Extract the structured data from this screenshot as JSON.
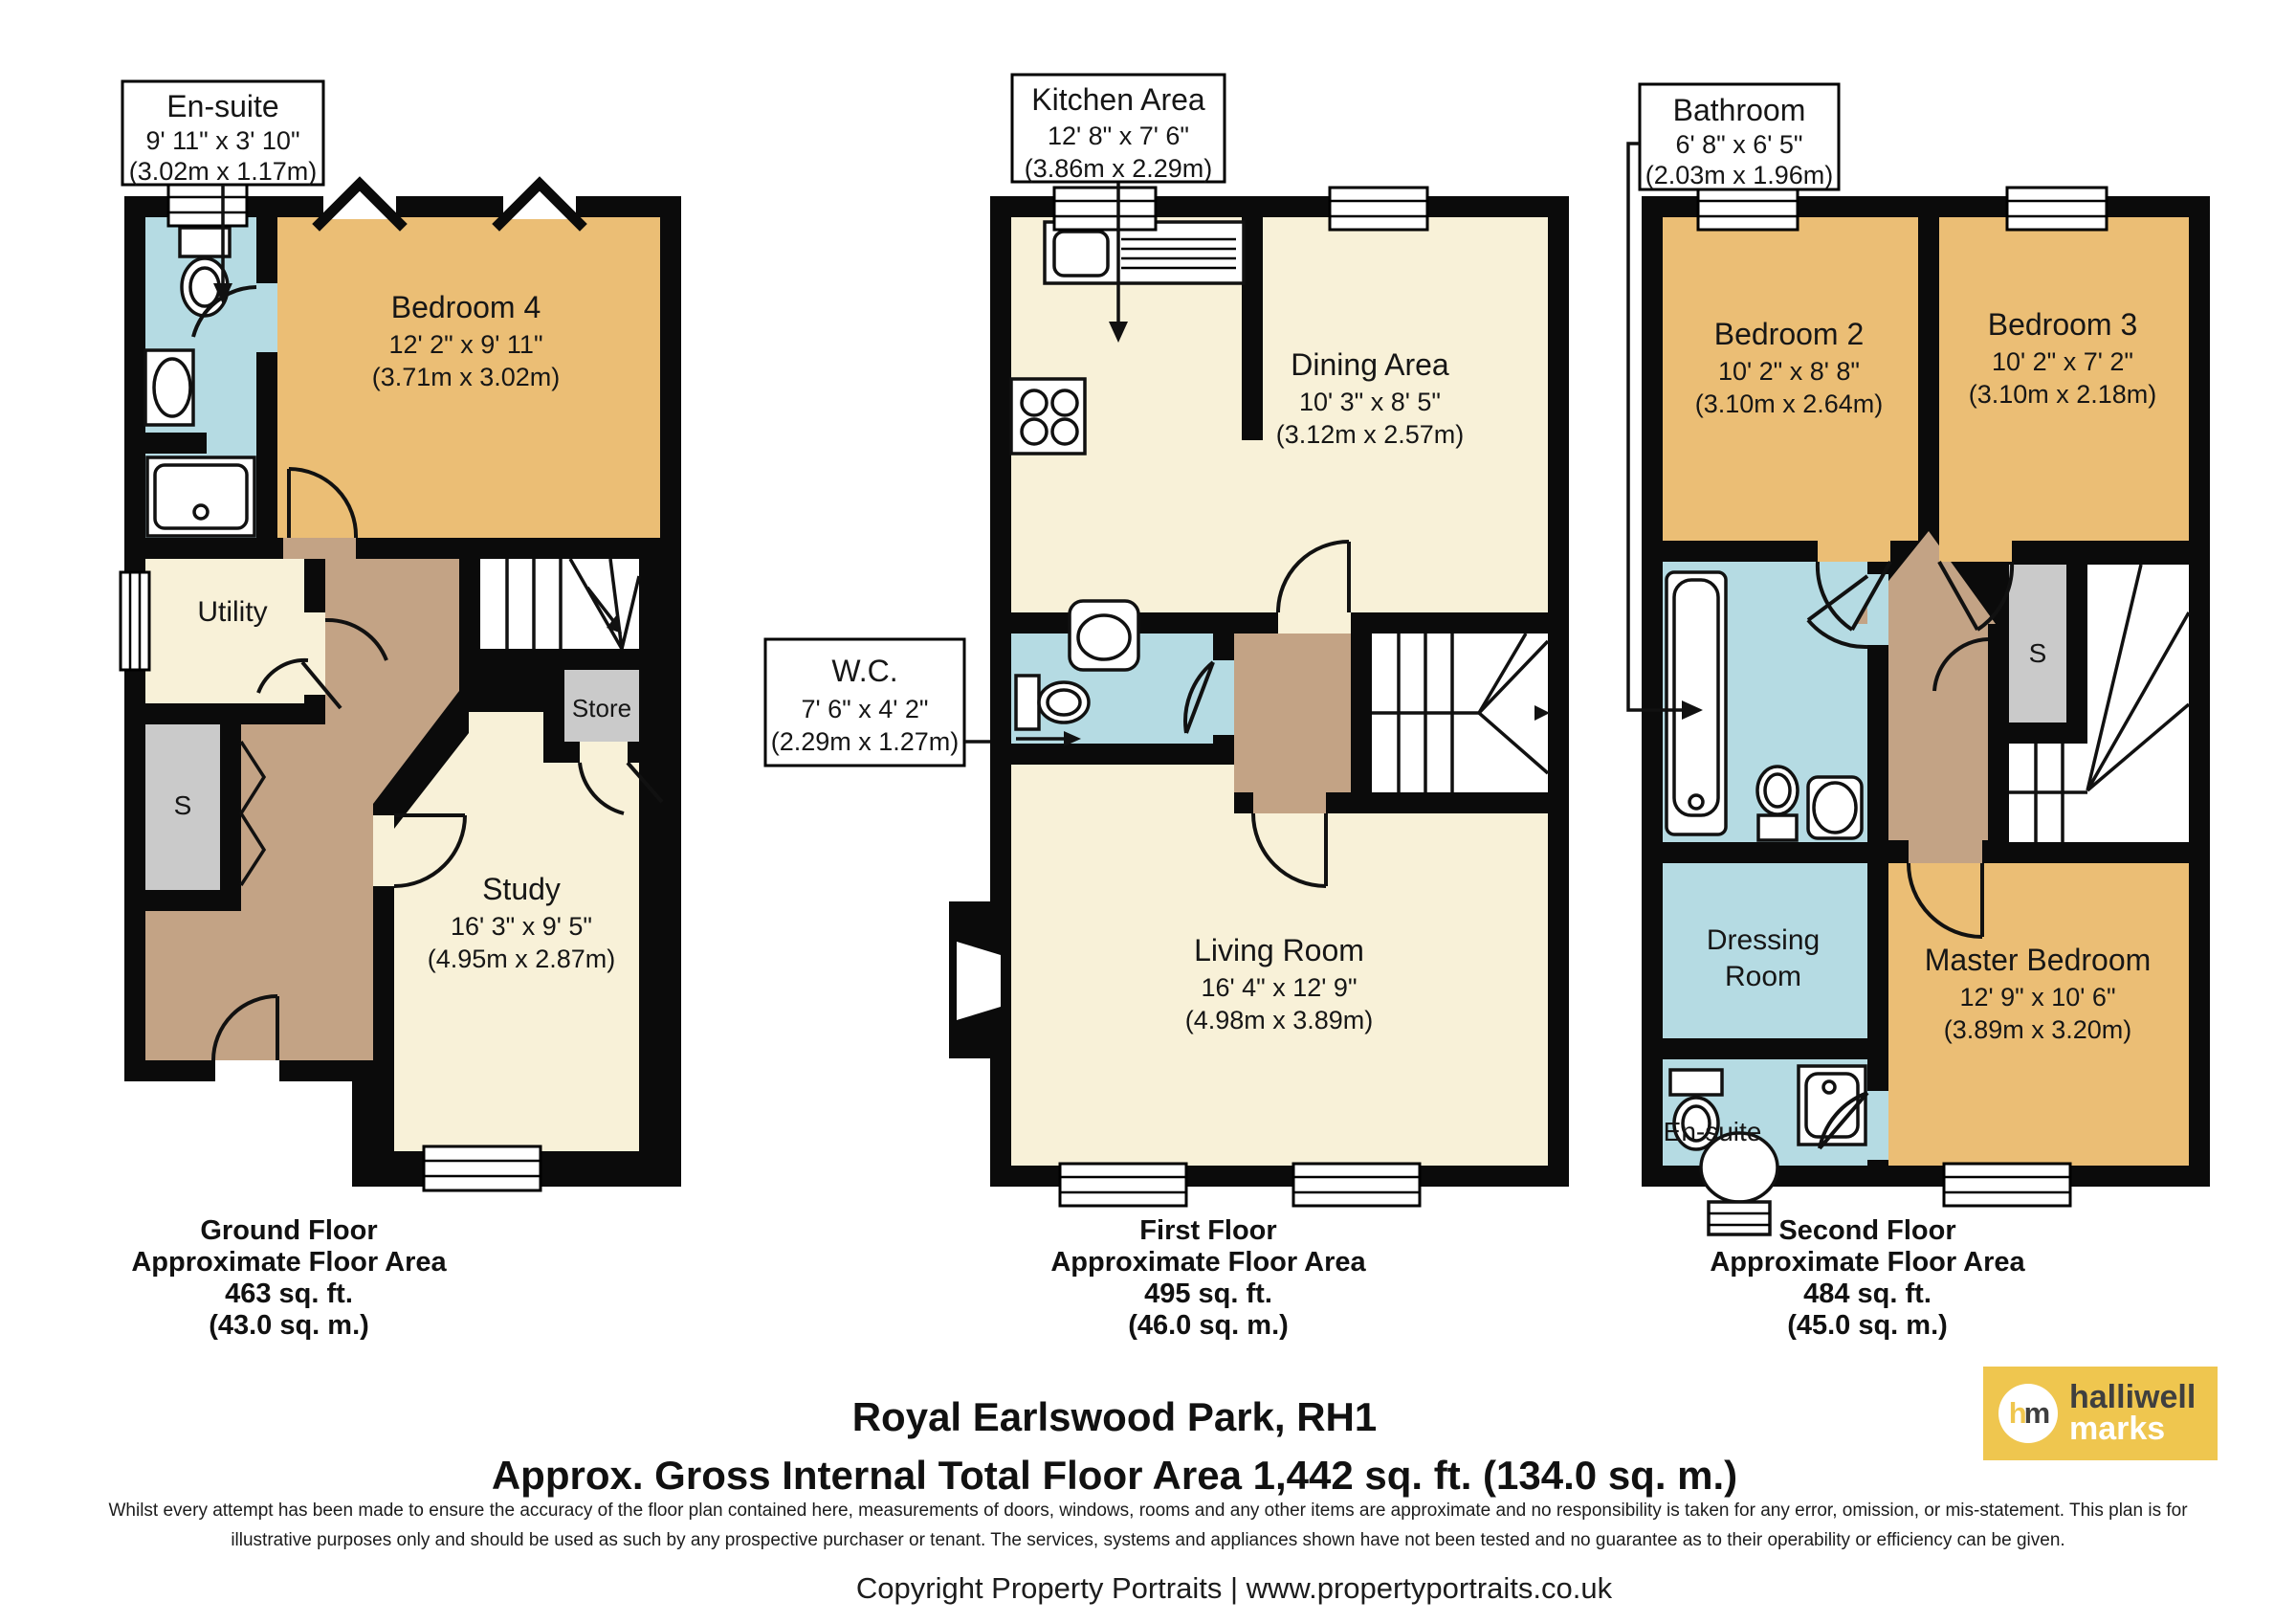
{
  "title": {
    "line1": "Royal Earlswood Park, RH1",
    "line2": "Approx. Gross Internal Total Floor Area 1,442 sq. ft. (134.0 sq. m.)"
  },
  "disclaimer": {
    "line1": "Whilst every attempt has been made to ensure the accuracy of the floor plan contained here, measurements of doors, windows, rooms and any other items are approximate and no responsibility is taken for any error, omission, or mis-statement. This plan is for",
    "line2": "illustrative purposes only and should be used as such by any prospective purchaser or tenant. The services, systems and appliances shown have not been tested and no guarantee as to their operability or efficiency can be given."
  },
  "copyright": "Copyright Property Portraits | www.propertyportraits.co.uk",
  "logo": {
    "letter_h": "h",
    "letter_m": "m",
    "word1": "halliwell",
    "word2": "marks"
  },
  "colors": {
    "room_tan": "#EBBE75",
    "room_cream": "#F8F1D8",
    "room_blue": "#B5DBE3",
    "hall_brown": "#C3A385",
    "cupboard_gray": "#CACACA",
    "wall": "#0B0B0B",
    "logo_yellow": "#EFC64F"
  },
  "floors": [
    {
      "caption": {
        "title": "Ground Floor",
        "subtitle": "Approximate Floor Area",
        "area_ft": "463 sq. ft.",
        "area_m": "(43.0 sq. m.)"
      },
      "boxes": {
        "ensuite": {
          "title": "En-suite",
          "imperial": "9' 11\" x 3' 10\"",
          "metric": "(3.02m x 1.17m)"
        }
      },
      "rooms": {
        "bedroom4": {
          "name": "Bedroom 4",
          "imperial": "12' 2\" x 9' 11\"",
          "metric": "(3.71m x 3.02m)"
        },
        "utility": {
          "name": "Utility"
        },
        "study": {
          "name": "Study",
          "imperial": "16' 3\" x 9' 5\"",
          "metric": "(4.95m x 2.87m)"
        },
        "store": {
          "name": "Store"
        },
        "cupboard": {
          "name": "S"
        }
      }
    },
    {
      "caption": {
        "title": "First Floor",
        "subtitle": "Approximate Floor Area",
        "area_ft": "495 sq. ft.",
        "area_m": "(46.0 sq. m.)"
      },
      "boxes": {
        "kitchen": {
          "title": "Kitchen Area",
          "imperial": "12' 8\" x 7' 6\"",
          "metric": "(3.86m x 2.29m)"
        },
        "wc": {
          "title": "W.C.",
          "imperial": "7' 6\" x 4' 2\"",
          "metric": "(2.29m x 1.27m)"
        }
      },
      "rooms": {
        "dining": {
          "name": "Dining Area",
          "imperial": "10' 3\" x 8' 5\"",
          "metric": "(3.12m x 2.57m)"
        },
        "living": {
          "name": "Living Room",
          "imperial": "16' 4\" x 12' 9\"",
          "metric": "(4.98m x 3.89m)"
        }
      }
    },
    {
      "caption": {
        "title": "Second Floor",
        "subtitle": "Approximate Floor Area",
        "area_ft": "484 sq. ft.",
        "area_m": "(45.0 sq. m.)"
      },
      "boxes": {
        "bathroom": {
          "title": "Bathroom",
          "imperial": "6' 8\" x 6' 5\"",
          "metric": "(2.03m x 1.96m)"
        }
      },
      "rooms": {
        "bedroom2": {
          "name": "Bedroom 2",
          "imperial": "10' 2\" x 8' 8\"",
          "metric": "(3.10m x 2.64m)"
        },
        "bedroom3": {
          "name": "Bedroom 3",
          "imperial": "10' 2\" x 7' 2\"",
          "metric": "(3.10m x 2.18m)"
        },
        "master": {
          "name": "Master Bedroom",
          "imperial": "12' 9\" x 10' 6\"",
          "metric": "(3.89m x 3.20m)"
        },
        "dressing": {
          "line1": "Dressing",
          "line2": "Room"
        },
        "ensuite": {
          "name": "En-suite"
        },
        "cupboard": {
          "name": "S"
        }
      }
    }
  ]
}
